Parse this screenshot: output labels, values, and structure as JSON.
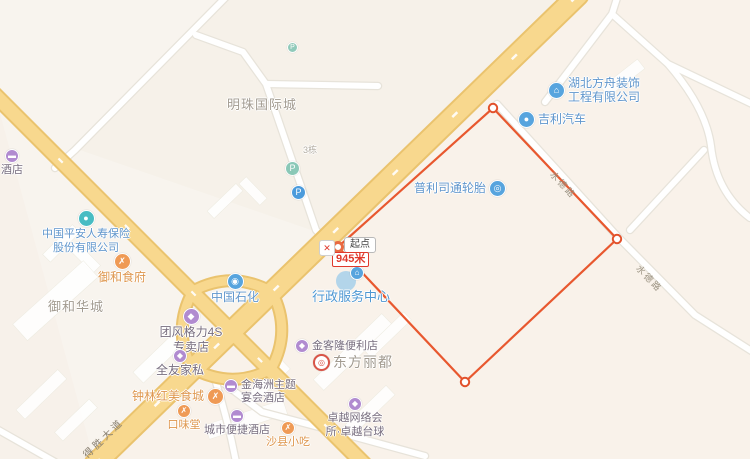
{
  "app": {
    "type": "map-distance-measurement"
  },
  "measure": {
    "start_label": "起点",
    "total_distance": "945米",
    "close_glyph": "✕"
  },
  "road_labels": {
    "main_avenue": "得胜大道",
    "shuide_upper": "水德路",
    "shuide_lower": "水德路"
  },
  "area_labels": {
    "pearl_city": "明珠国际城",
    "yuhe_huacheng": "御和华城",
    "building_3": "3栋"
  },
  "icons": {
    "parking": "P",
    "company": "⌂",
    "car": "●",
    "tire": "◎",
    "gas": "◉",
    "insurance": "●",
    "food": "✗",
    "hotel": "▬",
    "shop": "◆",
    "network": "◆",
    "admin": "⌂",
    "target": "◎"
  },
  "pois": [
    {
      "id": "left-edge-hotel",
      "lines": [
        "酒店"
      ]
    },
    {
      "id": "hubei-fangzhou",
      "lines": [
        "湖北方舟装饰",
        "工程有限公司"
      ]
    },
    {
      "id": "geely-auto",
      "lines": [
        "吉利汽车"
      ]
    },
    {
      "id": "bridgestone-tire",
      "lines": [
        "普利司通轮胎"
      ]
    },
    {
      "id": "pingan-insurance",
      "lines": [
        "中国平安人寿保险",
        "股份有限公司"
      ]
    },
    {
      "id": "yuhe-shifu",
      "lines": [
        "御和食府"
      ]
    },
    {
      "id": "sinopec",
      "lines": [
        "中国石化"
      ]
    },
    {
      "id": "admin-service-center",
      "lines": [
        "行政服务中心"
      ]
    },
    {
      "id": "tuanfeng-gree-4s",
      "lines": [
        "团风格力4S",
        "专卖店"
      ]
    },
    {
      "id": "quanyou-furniture",
      "lines": [
        "全友家私"
      ]
    },
    {
      "id": "zhonglinhong-food-city",
      "lines": [
        "钟林红美食城"
      ]
    },
    {
      "id": "jinhaizhou-hotel",
      "lines": [
        "金海洲主题",
        "宴会酒店"
      ]
    },
    {
      "id": "kouweitang",
      "lines": [
        "口味堂"
      ]
    },
    {
      "id": "city-comfort-inn",
      "lines": [
        "城市便捷酒店"
      ]
    },
    {
      "id": "shaxian-snacks",
      "lines": [
        "沙县小吃"
      ]
    },
    {
      "id": "jinkelong-store",
      "lines": [
        "金客隆便利店"
      ]
    },
    {
      "id": "dongfang-lidu",
      "lines": [
        "东方丽都"
      ]
    },
    {
      "id": "zhuoyue-net-billiards",
      "lines": [
        "卓越网络会",
        "所·卓越台球"
      ]
    }
  ],
  "colors": {
    "land": "#f8f4ee",
    "highway": "#f8d88e",
    "highway_casing": "#eac36e",
    "minor_road": "#ffffff",
    "measure_line": "#e8582f",
    "poi_blue": "#57a4de",
    "poi_purple": "#b18bd0",
    "poi_orange": "#ef9a55",
    "label_blue": "#6096cc",
    "label_orange": "#de964d",
    "label_gray": "#a29b90"
  }
}
